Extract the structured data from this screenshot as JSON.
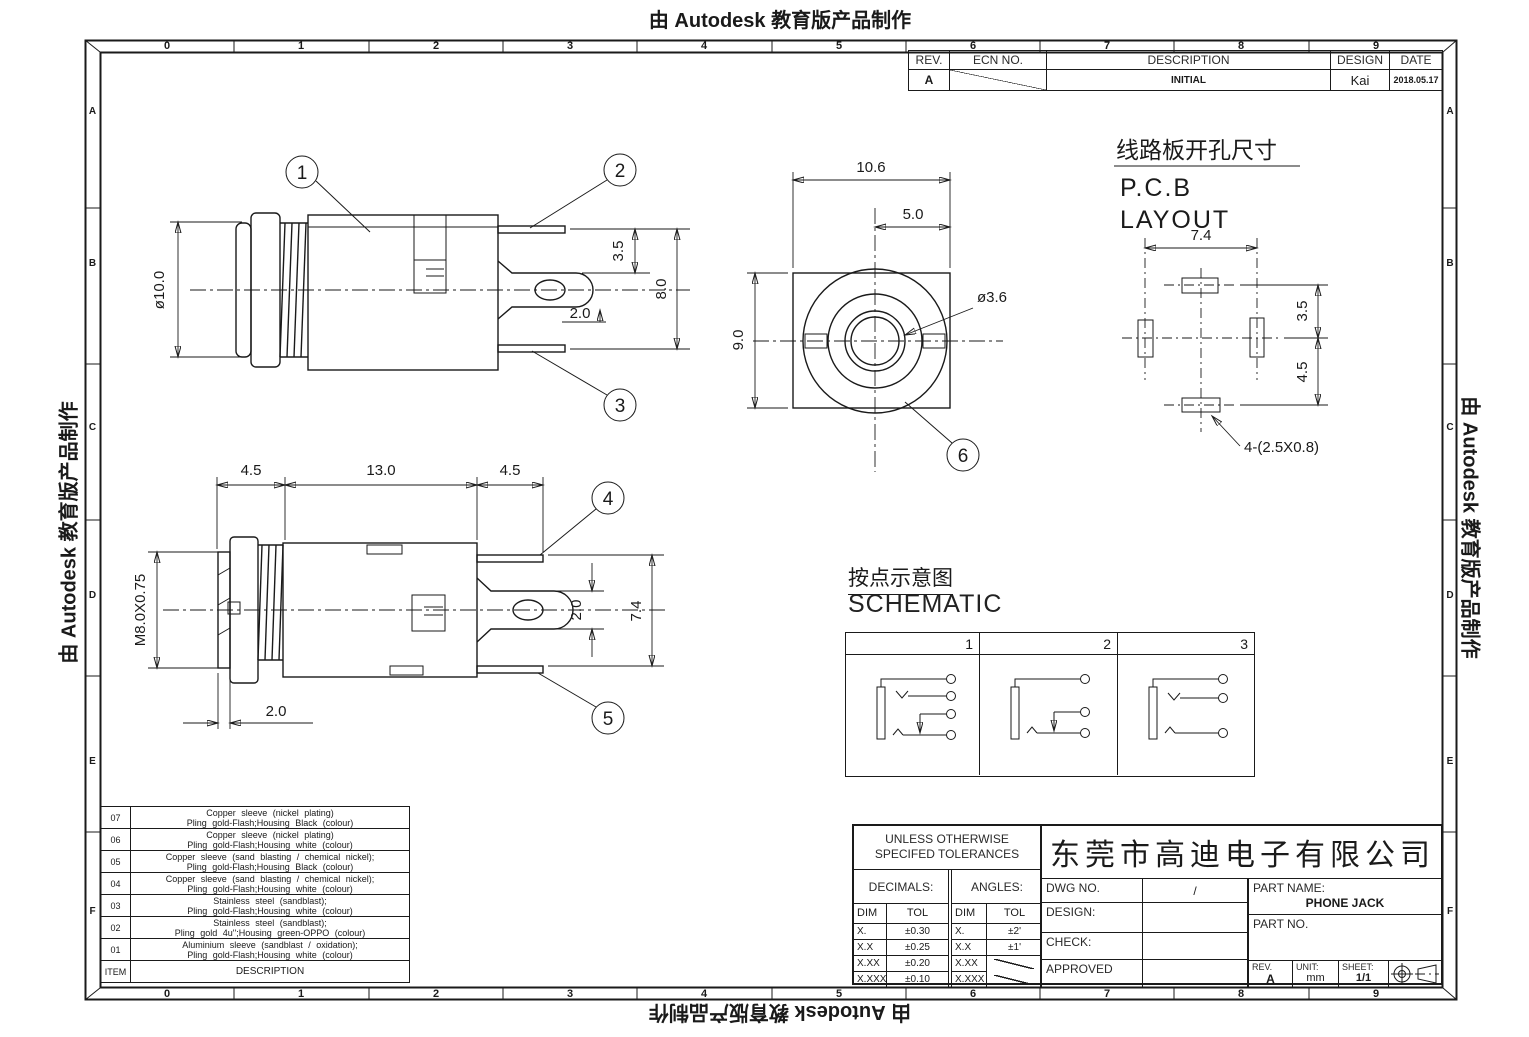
{
  "watermark": {
    "text": "由 Autodesk 教育版产品制作"
  },
  "frame": {
    "columns": [
      "0",
      "1",
      "2",
      "3",
      "4",
      "5",
      "6",
      "7",
      "8",
      "9"
    ],
    "rows": [
      "A",
      "B",
      "C",
      "D",
      "E",
      "F"
    ]
  },
  "revision_table": {
    "headers": {
      "rev": "REV.",
      "ecn": "ECN NO.",
      "description": "DESCRIPTION",
      "design": "DESIGN",
      "date": "DATE"
    },
    "row": {
      "rev": "A",
      "description": "INITIAL",
      "design": "Kai",
      "date": "2018.05.17"
    }
  },
  "views": {
    "side_view_1": {
      "dims": {
        "diameter": "ø10.0",
        "d35": "3.5",
        "d20": "2.0",
        "d80": "8.0"
      },
      "callouts": [
        "1",
        "2",
        "3"
      ]
    },
    "front_view": {
      "dims": {
        "w": "10.6",
        "half": "5.0",
        "h": "9.0",
        "hole": "ø3.6"
      },
      "callout": "6"
    },
    "pcb_layout": {
      "title_cn": "线路板开孔尺寸",
      "title_en_1": "P.C.B",
      "title_en_2": "LAYOUT",
      "dims": {
        "w": "7.4",
        "d35": "3.5",
        "d45": "4.5"
      },
      "pad_label": "4-(2.5X0.8)"
    },
    "side_view_2": {
      "dims": {
        "left": "4.5",
        "mid": "13.0",
        "right": "4.5",
        "thread": "M8.0X0.75",
        "bottom": "2.0",
        "pin": "2.0",
        "height": "7.4"
      },
      "callouts": [
        "4",
        "5"
      ]
    }
  },
  "schematic": {
    "title_cn": "按点示意图",
    "title_en": "SCHEMATIC",
    "panels": [
      "1",
      "2",
      "3"
    ]
  },
  "parts_table": {
    "header": {
      "item": "ITEM",
      "description": "DESCRIPTION"
    },
    "rows": [
      {
        "item": "07",
        "line1": "Copper sleeve (nickel plating)",
        "line2": "Pling gold-Flash;Housing Black (colour)"
      },
      {
        "item": "06",
        "line1": "Copper sleeve (nickel plating)",
        "line2": "Pling gold-Flash;Housing white (colour)"
      },
      {
        "item": "05",
        "line1": "Copper sleeve (sand blasting / chemical nickel);",
        "line2": "Pling gold-Flash;Housing Black (colour)"
      },
      {
        "item": "04",
        "line1": "Copper sleeve (sand blasting / chemical nickel);",
        "line2": "Pling gold-Flash;Housing white (colour)"
      },
      {
        "item": "03",
        "line1": "Stainless steel (sandblast);",
        "line2": "Pling gold-Flash;Housing white (colour)"
      },
      {
        "item": "02",
        "line1": "Stainless steel (sandblast);",
        "line2": "Pling gold 4u'';Housing green-OPPO (colour)"
      },
      {
        "item": "01",
        "line1": "Aluminium sleeve (sandblast / oxidation);",
        "line2": "Pling gold-Flash;Housing white (colour)"
      }
    ]
  },
  "title_block": {
    "tolerances": {
      "title_1": "UNLESS OTHERWISE",
      "title_2": "SPECIFED TOLERANCES",
      "decimals_label": "DECIMALS:",
      "angles_label": "ANGLES:",
      "dim_header": "DIM",
      "tol_header": "TOL",
      "decimal_rows": [
        {
          "dim": "X.",
          "tol": "±0.30"
        },
        {
          "dim": "X.X",
          "tol": "±0.25"
        },
        {
          "dim": "X.XX",
          "tol": "±0.20"
        },
        {
          "dim": "X.XXX",
          "tol": "±0.10"
        }
      ],
      "angle_rows": [
        {
          "dim": "X.",
          "tol": "±2'"
        },
        {
          "dim": "X.X",
          "tol": "±1'"
        },
        {
          "dim": "X.XX",
          "tol": ""
        },
        {
          "dim": "X.XXX",
          "tol": ""
        }
      ]
    },
    "fields": {
      "dwg_no_label": "DWG NO.",
      "dwg_no_value": "/",
      "design_label": "DESIGN:",
      "check_label": "CHECK:",
      "approved_label": "APPROVED"
    },
    "company": "东莞市高迪电子有限公司",
    "part_name_label": "PART NAME:",
    "part_name": "PHONE JACK",
    "part_no_label": "PART NO.",
    "rev_label": "REV.",
    "rev": "A",
    "unit_label": "UNIT:",
    "unit": "mm",
    "sheet_label": "SHEET:",
    "sheet": "1/1"
  }
}
